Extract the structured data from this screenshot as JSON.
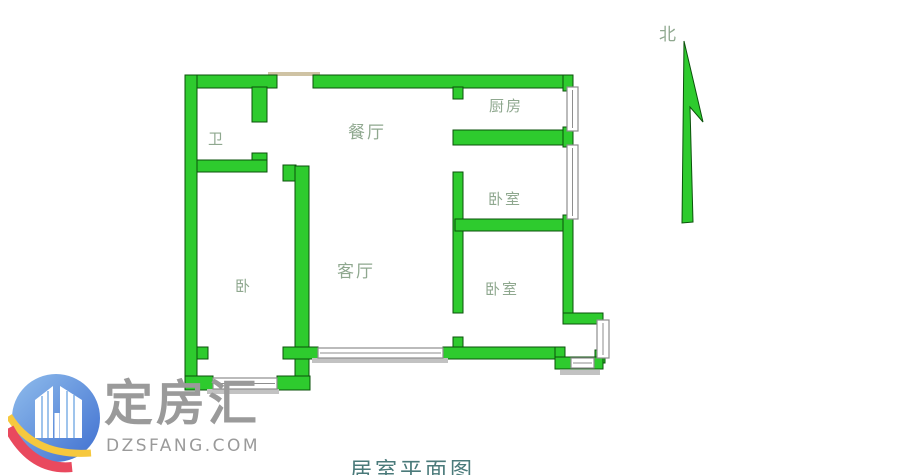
{
  "floor_plan": {
    "rooms": [
      {
        "id": "bathroom",
        "label": "卫"
      },
      {
        "id": "dining-room",
        "label": "餐厅"
      },
      {
        "id": "kitchen",
        "label": "厨房"
      },
      {
        "id": "bedroom-middle",
        "label": "卧室"
      },
      {
        "id": "bedroom-left",
        "label": "卧"
      },
      {
        "id": "living-room",
        "label": "客厅"
      },
      {
        "id": "bedroom-bottom",
        "label": "卧室"
      }
    ],
    "north_label": "北",
    "colors": {
      "wall_fill": "#2ecb2e",
      "wall_outline": "#0b520b",
      "room_label": "#8fa88f",
      "window_frame": "#8e8e8e",
      "door_lintel": "#cfc3a4",
      "background": "#ffffff"
    }
  },
  "watermark": {
    "brand": "定房汇",
    "site": "DZSFANG.COM",
    "colors": {
      "circle_light": "#90bdec",
      "circle_dark": "#3f6fd0",
      "towers": "#ffffff",
      "arc_yellow": "#f6c83e",
      "arc_red": "#e9495e",
      "text": "#9a9a9a"
    }
  },
  "caption": {
    "text": "居室平面图"
  }
}
